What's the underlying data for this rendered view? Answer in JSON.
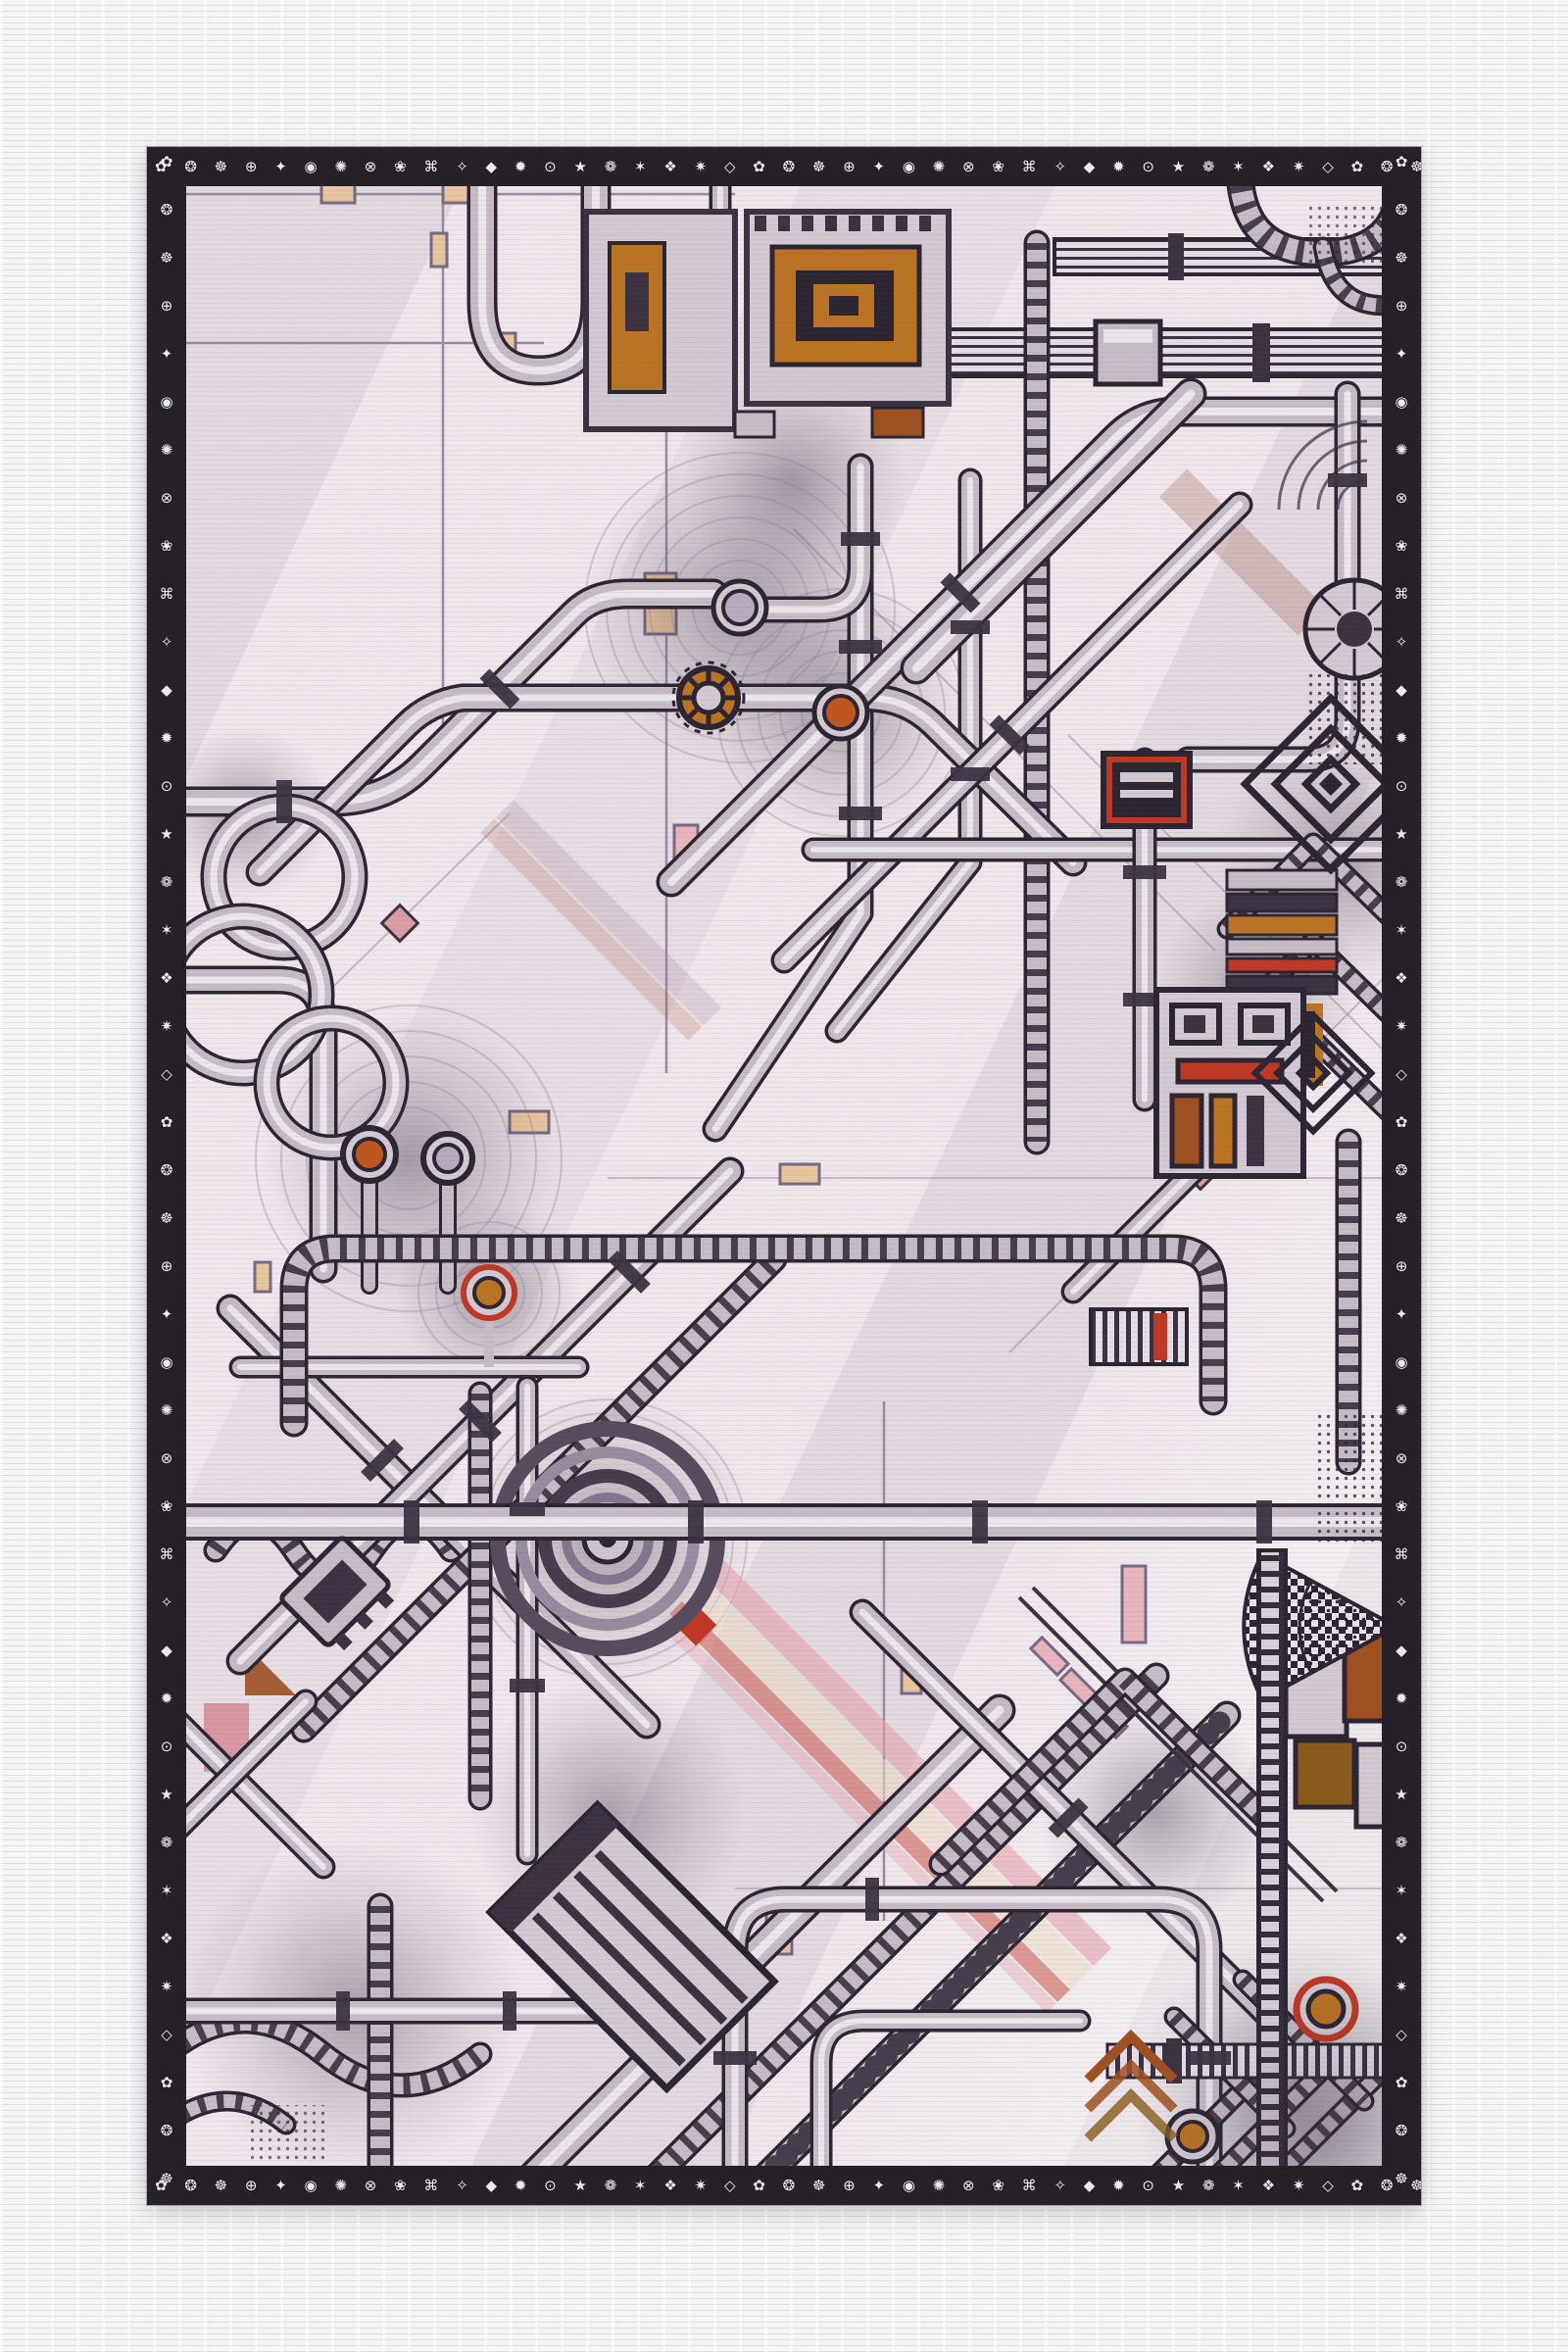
{
  "artwork": {
    "border": {
      "sequence": "✿ ❂ ☸ ⊕ ✦ ◉ ✺ ⊗ ❀ ⌘ ✧ ◆ ✹ ⊙ ★ ❁ ✶ ❖ ✷ ◇ ",
      "repeat": 6
    },
    "palette": {
      "ink": "#2a2330",
      "ink2": "#3a3140",
      "pipe": "#c9bfc9",
      "pipe_hi": "#f4f0f4",
      "panel": "#d6cdd6",
      "rib": "#453c4c",
      "canvas_bg": "#f3ebf0",
      "margin_bg": "#f7f6f7",
      "margin_line": "#dedce0",
      "frame_bg": "#262029",
      "glyph": "#eceaef",
      "grid": "#9d8ba4",
      "halo": "#8f7d98",
      "orange": "#bd7520",
      "rust": "#a0501d",
      "amber": "#8a5a17",
      "red": "#c23722",
      "red_deep": "#8f2418",
      "tan": "#ecc9a0",
      "pink": "#edb9c0",
      "pink_deep": "#d9929b",
      "pink_diamond": "#dfa0a5",
      "lavender_dk": "#776a85"
    }
  }
}
